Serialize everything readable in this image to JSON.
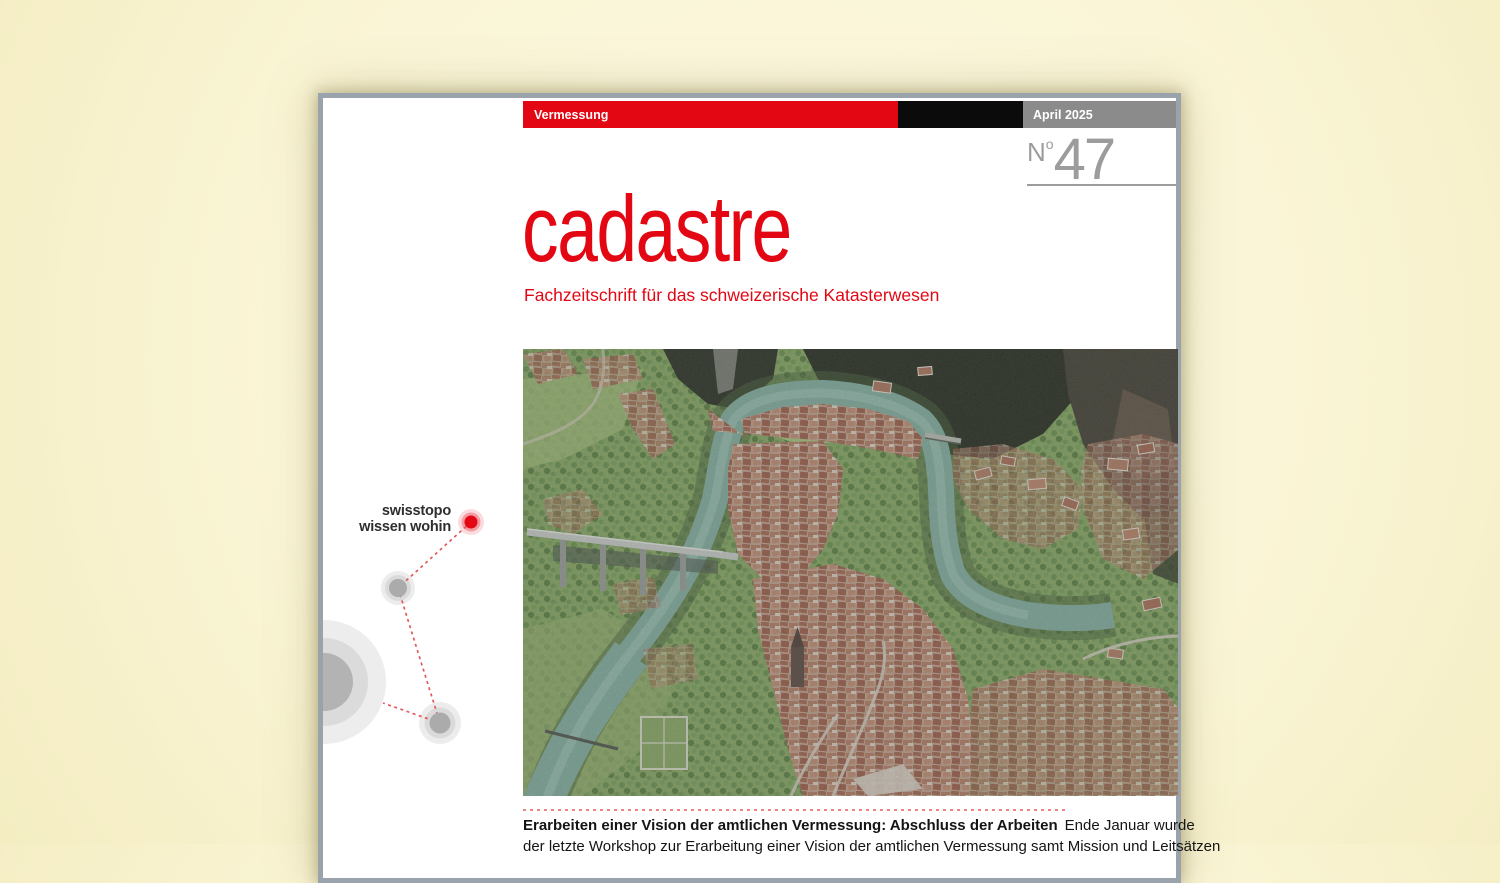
{
  "document": {
    "masthead": {
      "category": "Vermessung",
      "date": "April 2025",
      "issue_prefix": "N",
      "issue_sup": "o",
      "issue_number": "47"
    },
    "title": "cadastre",
    "subtitle": "Fachzeitschrift für das schweizerische Katasterwesen",
    "logo": {
      "line1": "swisstopo",
      "line2": "wissen wohin"
    },
    "teaser": {
      "lead_bold": "Erarbeiten einer Vision der amtlichen Vermessung: Abschluss der Arbeiten",
      "lead_rest": "Ende Januar wurde",
      "line2": "der letzte Workshop zur Erarbeitung einer Vision der amtlichen Vermessung samt Mission und Leitsätzen"
    },
    "photo_alt": "Oblique aerial photogrammetry view of the Fribourg old town: red tiled roofs inside a teal river loop, stone arch viaduct, wooded gorge cliffs",
    "colors": {
      "background_cream": "#FAF5D6",
      "brand_red": "#E30613",
      "bar_black": "#0B0B0B",
      "bar_gray": "#8B8B8B",
      "issue_gray": "#9C9C9C",
      "page_border_gray": "#9AA2AB",
      "dotted_separator_red": "#EE8585",
      "river_teal": "#7FAE9E",
      "roof_brown": "#B07A5F"
    }
  }
}
